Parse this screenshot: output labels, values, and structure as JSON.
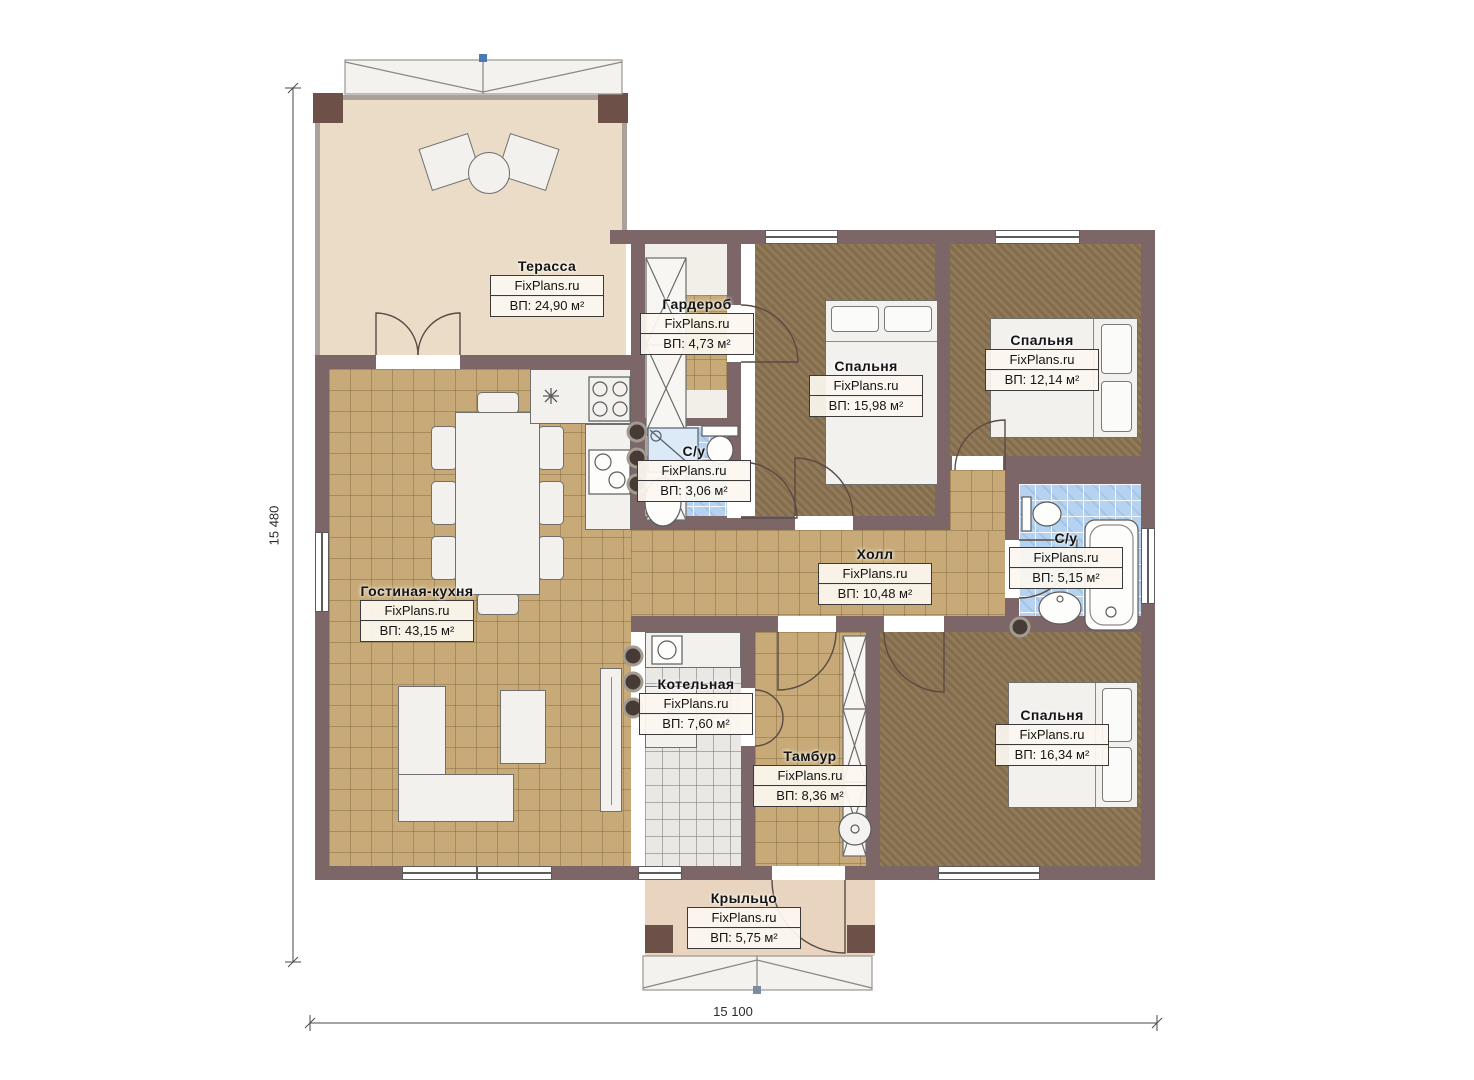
{
  "brand": "FixPlans.ru",
  "rooms": {
    "terrace": {
      "name": "Терасса",
      "area": "ВП: 24,90 м²"
    },
    "wardrobe": {
      "name": "Гардероб",
      "area": "ВП: 4,73 м²"
    },
    "bedroom_top": {
      "name": "Спальня",
      "area": "ВП: 15,98 м²"
    },
    "bedroom_right": {
      "name": "Спальня",
      "area": "ВП: 12,14 м²"
    },
    "bath_small": {
      "name": "С/у",
      "area": "ВП: 3,06 м²"
    },
    "hall": {
      "name": "Холл",
      "area": "ВП: 10,48 м²"
    },
    "bath_big": {
      "name": "С/у",
      "area": "ВП: 5,15 м²"
    },
    "living": {
      "name": "Гостиная-кухня",
      "area": "ВП: 43,15 м²"
    },
    "boiler": {
      "name": "Котельная",
      "area": "ВП: 7,60 м²"
    },
    "vestibule": {
      "name": "Тамбур",
      "area": "ВП: 8,36 м²"
    },
    "bedroom_bottom": {
      "name": "Спальня",
      "area": "ВП: 16,34 м²"
    },
    "porch": {
      "name": "Крыльцо",
      "area": "ВП: 5,75 м²"
    }
  },
  "dimensions": {
    "height_total": "15 480",
    "width_total": "15 100"
  },
  "annotations": {
    "washing_machine": "Ст.М"
  },
  "colors": {
    "wall": "#7c6667",
    "post": "#6d5148",
    "terrace_floor": "#ebdcc7",
    "tile_floor": "#c7aa78",
    "bedroom_floor": "#8a7351",
    "bath_tile": "#b5d3f0",
    "boiler_floor": "#eae8e4",
    "accent_marker": "#4a7ab5"
  }
}
